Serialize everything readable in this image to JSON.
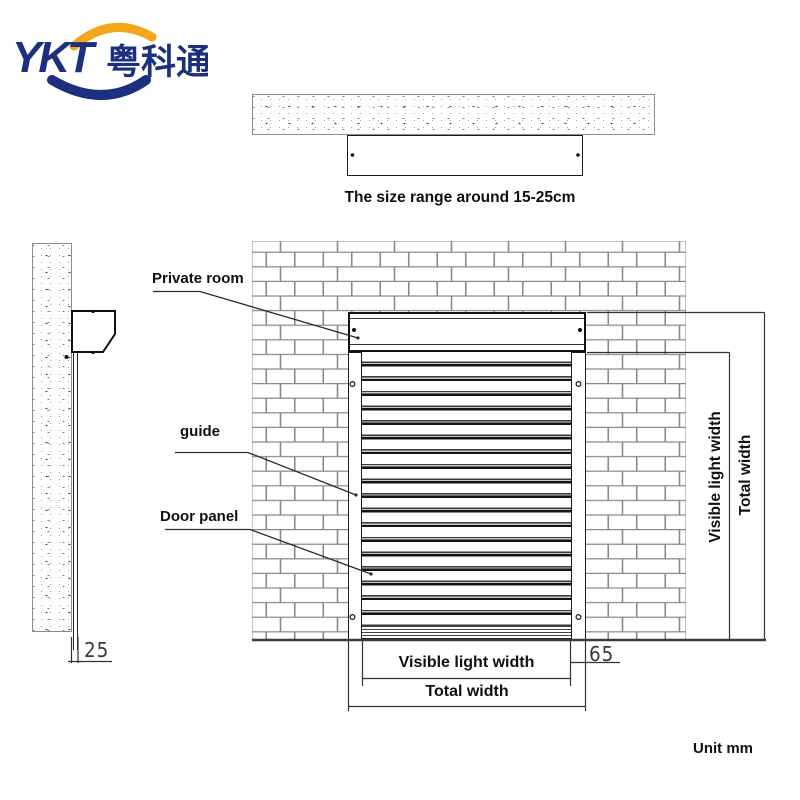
{
  "logo": {
    "abbr": "YKT",
    "cn": "粤科通"
  },
  "top_view": {
    "caption": "The size range around 15-25cm"
  },
  "labels": {
    "private_room": "Private room",
    "guide": "guide",
    "door_panel": "Door panel"
  },
  "dims": {
    "right_visible": "Visible light width",
    "right_total": "Total width",
    "bottom_visible": "Visible light width",
    "bottom_total": "Total width",
    "guide_width": "65",
    "panel_thickness": "25"
  },
  "footer": {
    "unit": "Unit mm"
  },
  "colors": {
    "navy": "#1d2f7f",
    "yellow": "#f3a71d",
    "line": "#2e2e2e"
  }
}
